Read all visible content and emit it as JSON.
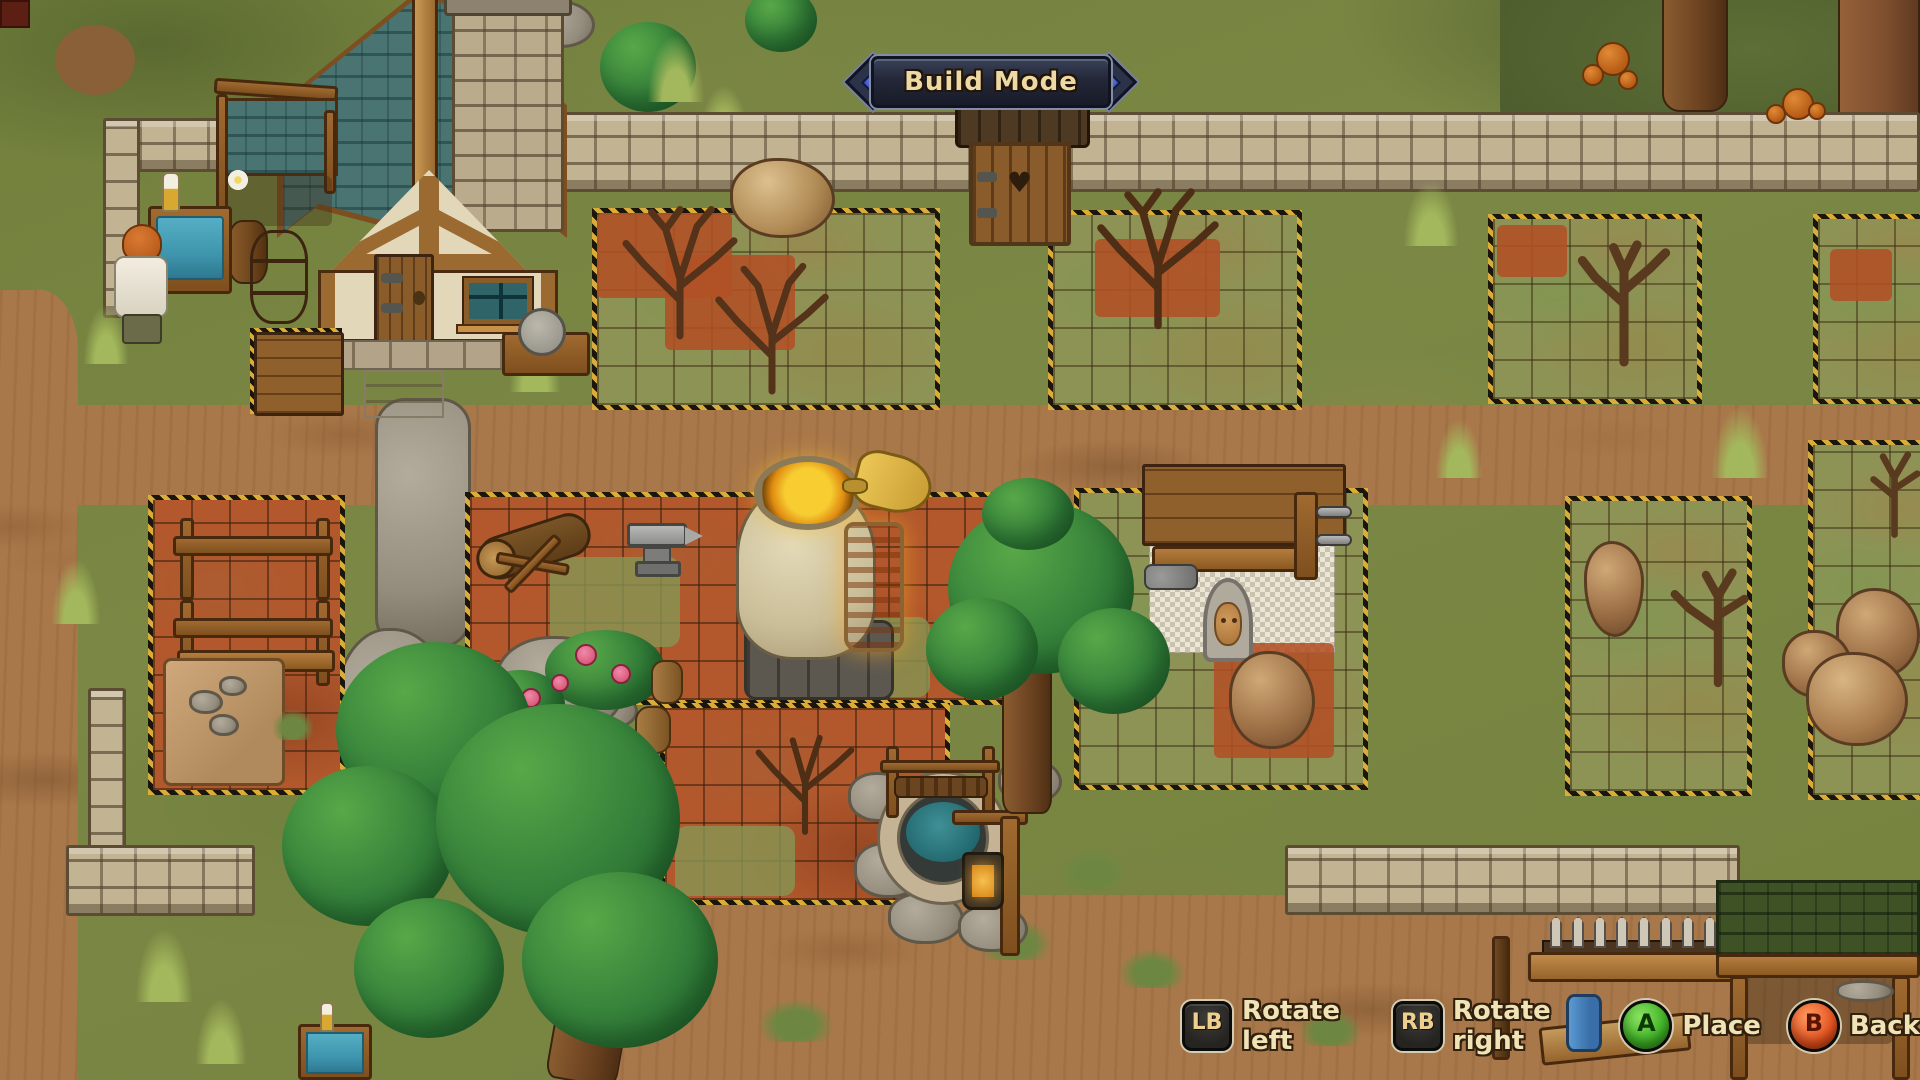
{
  "hud": {
    "mode_banner": {
      "label": "Build Mode"
    },
    "hints": [
      {
        "button": "LB",
        "label": "Rotate left"
      },
      {
        "button": "RB",
        "label": "Rotate right"
      },
      {
        "button": "A",
        "label": "Place"
      },
      {
        "button": "B",
        "label": "Back"
      }
    ]
  },
  "palette": {
    "banner_bg": "#232738",
    "banner_rim": "#838da6",
    "banner_gem": "#3e57c6",
    "banner_text": "#ecd9a4",
    "hint_text": "#f0e3b6",
    "shoulder_button_bg": "#2d2c28",
    "a_button_green": "#43b629",
    "b_button_red": "#e5521f",
    "hazard_yellow": "#d9ad37",
    "hazard_black": "#1a160d",
    "zone_red_soil": "#b2582c",
    "zone_grass": "#8d9355",
    "grass": "#7b8845",
    "dirt_road": "#a9784a",
    "roof_teal": "#4a7472",
    "wood": "#9a6a30",
    "stone_wall": "#c2b393",
    "water_teal": "#3e96ae",
    "tree_green": "#34803a",
    "furnace_glow": "#f3c02a"
  },
  "scene": {
    "zones": [
      {
        "id": "top-left",
        "terrain": "grass",
        "contents": [
          "dead-bushes",
          "red-soil-patches",
          "rock"
        ]
      },
      {
        "id": "top-center",
        "terrain": "grass",
        "contents": [
          "dead-bush",
          "red-soil-patch"
        ]
      },
      {
        "id": "top-right",
        "terrain": "grass",
        "contents": [
          "dead-tree",
          "red-soil-patch"
        ]
      },
      {
        "id": "top-far-right",
        "terrain": "grass",
        "contents": [
          "red-soil-patch"
        ]
      },
      {
        "id": "mid-left",
        "terrain": "red-soil",
        "contents": [
          "timber-racks",
          "stone-tarp"
        ]
      },
      {
        "id": "mid-center",
        "terrain": "red-soil",
        "contents": [
          "chopping-log",
          "anvil",
          "furnace",
          "bellows",
          "dead-bush"
        ]
      },
      {
        "id": "mid-right",
        "terrain": "grass",
        "contents": [
          "carpenter-workbench",
          "placement-tiles",
          "face-idol",
          "rock"
        ]
      },
      {
        "id": "far-right",
        "terrain": "grass",
        "contents": [
          "standing-rock",
          "dead-tree"
        ]
      },
      {
        "id": "edge-right",
        "terrain": "grass",
        "contents": [
          "boulders",
          "dead-tree"
        ]
      }
    ],
    "objects": [
      "house",
      "lean-to",
      "chimney",
      "outhouse",
      "stone-walls",
      "furnace",
      "anvil",
      "chopping-log",
      "carpenter-workbench",
      "face-idol",
      "timber-racks",
      "stone-tarp",
      "wooden-crate",
      "washing-tub",
      "washstand",
      "character",
      "grindstone",
      "well",
      "lantern-post",
      "picket-fence",
      "green-roof-shed",
      "trees",
      "dead-trees",
      "rocks",
      "boulders",
      "mushrooms",
      "rose-rock",
      "cobblestone-path"
    ]
  }
}
